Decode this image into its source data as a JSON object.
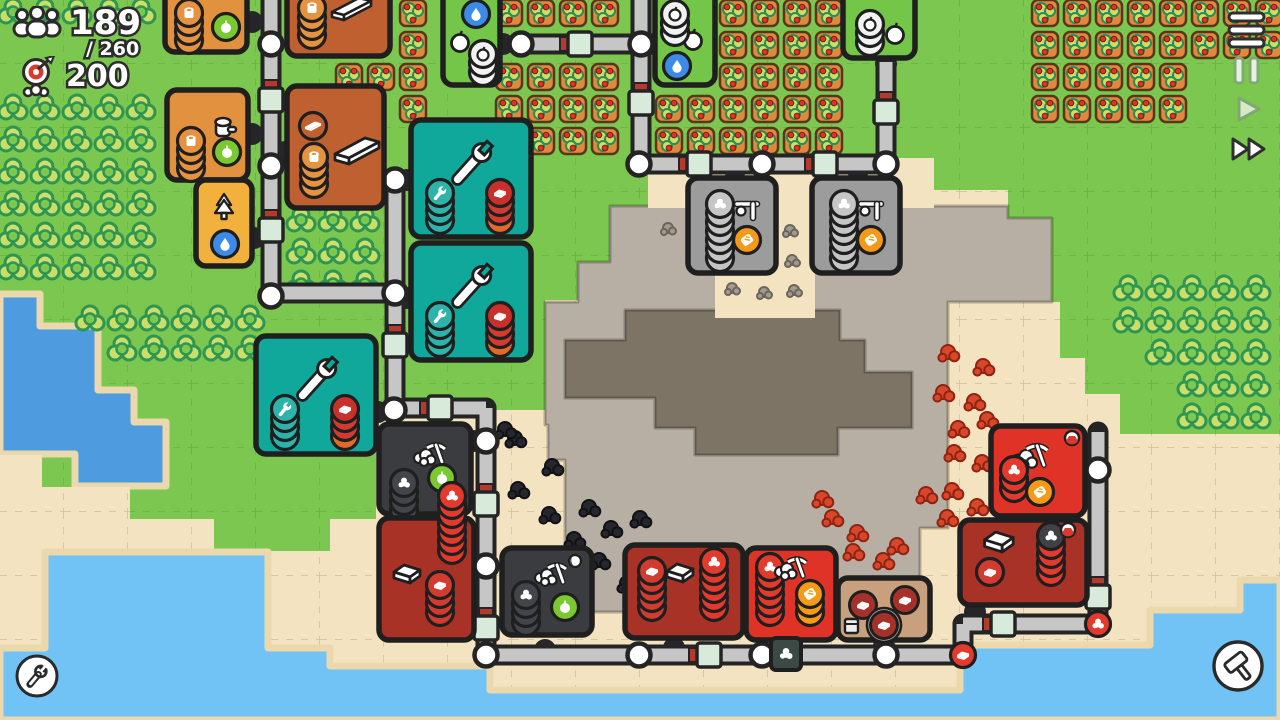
{
  "hud": {
    "population": {
      "current": "189",
      "max_label": "/ 260",
      "icon": "population-icon"
    },
    "goal": {
      "value": "200",
      "icon": "target-goal-icon"
    }
  },
  "controls": {
    "menu": "menu",
    "pause": "pause",
    "play": "play",
    "fast_forward": "fast-forward",
    "tools": "wrench-tools",
    "build": "build-hammer"
  },
  "map": {
    "colors": {
      "grass": "#7CC74F",
      "sand": "#F4E3C0",
      "quarry": "#B7AFA3",
      "quarryInner": "#7E7466",
      "lake": "#4E9BE0",
      "ocean": "#72C3F5",
      "shore": "#EBD8AD",
      "outline": "#1F1F1F",
      "beltGray": "#C6C6C6",
      "beltDark": "#242424",
      "mint": "#D8EBDA",
      "stripe": "#B23A2E",
      "teal": "#0FA89B",
      "tealCoin": "#2DB3A9",
      "lightOrange": "#E2913F",
      "darkOrange": "#BF6030",
      "amber": "#F2B13D",
      "farmGreen": "#74C649",
      "gray": "#9C9C9C",
      "grayCoin": "#C6C6C6",
      "dark": "#3A3C40",
      "coalCoin": "#43454A",
      "darkRed": "#A93226",
      "red": "#DF3328",
      "redCoin": "#E23A2C",
      "brown": "#C8A07E",
      "appleGreen": "#7CC832",
      "waterCoin": "#3D8BE8",
      "orangeCoin": "#F59A18",
      "treeFill": "#C9DF69",
      "treeStroke": "#2E9552",
      "treeInner": "#7CC94F",
      "berryTile": "#E2883E",
      "berryBorder": "#54381B",
      "berry": "#E03028",
      "coal": "#26272C",
      "iron": "#D8472A",
      "stone": "#A29B8F"
    },
    "terrain": {
      "sand": "M0,455 H42 V487 H130 V519 H214 V551 H330 V519 H376 V410 H545 V300 H578 V262 H610 V206 H648 V158 H934 V190 H1008 V218 H1052 V302 H1060 V358 H1085 V394 H1120 V434 H1280 V720 H0 Z",
      "quarry": "M545,302 H578 V262 H610 V206 H1008 V218 H1052 V302 H948 V528 H920 V612 H590 V560 H565 V460 H548 V425 H545 Z",
      "quarryInner": "M565,340 H625 V310 H840 V340 H865 V372 H912 V428 H838 V455 H695 V428 H655 V398 H565 Z",
      "lake": "M0,294 L40,294 L40,326 L98,326 L98,390 L134,390 L134,422 L166,422 L166,486 L75,486 L75,454 L0,454 Z",
      "ocean": "M0,648 H45 V552 H268 V648 H330 V666 H490 V690 H960 V645 H1150 V610 H1240 V580 H1280 V720 H0 Z",
      "sandPatches": [
        [
          648,
          160,
          286,
          48
        ],
        [
          772,
          205,
          42,
          113
        ],
        [
          715,
          272,
          100,
          46
        ]
      ]
    },
    "tiles": {
      "berries": [
        [
          13,
          [
            413,
            509,
            541,
            573,
            605,
            733,
            765,
            797,
            829,
            1045,
            1077,
            1109,
            1141,
            1173,
            1205,
            1237,
            1269
          ]
        ],
        [
          45,
          [
            413,
            733,
            765,
            797,
            829,
            1045,
            1077,
            1109,
            1141,
            1173,
            1205,
            1237,
            1269
          ]
        ],
        [
          77,
          [
            349,
            381,
            413,
            509,
            541,
            573,
            605,
            733,
            765,
            797,
            829,
            1045,
            1077,
            1109,
            1141,
            1173
          ]
        ],
        [
          109,
          [
            413,
            509,
            541,
            573,
            605,
            669,
            701,
            733,
            765,
            797,
            829,
            1045,
            1077,
            1109,
            1141,
            1173
          ]
        ],
        [
          141,
          [
            541,
            573,
            605,
            669,
            701,
            733,
            765,
            797,
            829
          ]
        ]
      ],
      "trees": [
        [
          13,
          [
            13,
            45,
            77,
            109,
            141
          ]
        ],
        [
          109,
          [
            13,
            45,
            77,
            109,
            141
          ]
        ],
        [
          141,
          [
            13,
            45,
            77,
            109,
            141
          ]
        ],
        [
          173,
          [
            13,
            45,
            77,
            109,
            141
          ]
        ],
        [
          205,
          [
            13,
            45,
            77,
            109,
            141
          ]
        ],
        [
          237,
          [
            13,
            45,
            77,
            109,
            141
          ]
        ],
        [
          269,
          [
            13,
            45,
            77,
            109,
            141
          ]
        ],
        [
          221,
          [
            301,
            333,
            365
          ]
        ],
        [
          253,
          [
            301,
            333,
            365
          ]
        ],
        [
          285,
          [
            301,
            333,
            365
          ]
        ],
        [
          320,
          [
            90,
            122,
            154,
            186,
            218,
            250
          ]
        ],
        [
          350,
          [
            122,
            154,
            186,
            218,
            250
          ]
        ],
        [
          290,
          [
            1128,
            1160,
            1192,
            1224,
            1256
          ]
        ],
        [
          322,
          [
            1128,
            1160,
            1192,
            1224,
            1256
          ]
        ],
        [
          354,
          [
            1160,
            1192,
            1224,
            1256
          ]
        ],
        [
          386,
          [
            1192,
            1224,
            1256
          ]
        ],
        [
          418,
          [
            1192,
            1224,
            1256
          ]
        ]
      ],
      "stone": [
        [
          668,
          228
        ],
        [
          790,
          230
        ],
        [
          792,
          260
        ],
        [
          732,
          288
        ],
        [
          764,
          292
        ],
        [
          794,
          290
        ]
      ],
      "coal": [
        [
          515,
          438
        ],
        [
          552,
          466
        ],
        [
          518,
          489
        ],
        [
          549,
          514
        ],
        [
          589,
          507
        ],
        [
          574,
          539
        ],
        [
          611,
          528
        ],
        [
          640,
          518
        ],
        [
          599,
          560
        ],
        [
          556,
          584
        ],
        [
          627,
          583
        ],
        [
          650,
          553
        ],
        [
          505,
          429
        ]
      ],
      "iron": [
        [
          948,
          352
        ],
        [
          983,
          366
        ],
        [
          943,
          392
        ],
        [
          974,
          401
        ],
        [
          958,
          428
        ],
        [
          987,
          419
        ],
        [
          954,
          452
        ],
        [
          982,
          462
        ],
        [
          952,
          490
        ],
        [
          977,
          506
        ],
        [
          926,
          494
        ],
        [
          947,
          517
        ],
        [
          832,
          517
        ],
        [
          857,
          532
        ],
        [
          883,
          560
        ],
        [
          853,
          551
        ],
        [
          897,
          545
        ],
        [
          822,
          498
        ]
      ]
    },
    "belts": {
      "segments": [
        [
          271,
          -8,
          271,
          296
        ],
        [
          641,
          -8,
          641,
          164
        ],
        [
          521,
          44,
          641,
          44
        ],
        [
          639,
          164,
          886,
          164
        ],
        [
          886,
          62,
          886,
          164
        ],
        [
          395,
          178,
          395,
          410
        ],
        [
          271,
          293,
          395,
          293
        ],
        [
          394,
          408,
          486,
          408
        ],
        [
          486,
          408,
          486,
          655
        ],
        [
          486,
          655,
          963,
          655
        ],
        [
          963,
          624,
          963,
          655
        ],
        [
          963,
          624,
          1098,
          624
        ],
        [
          1098,
          432,
          1098,
          624
        ]
      ],
      "nodes": [
        [
          271,
          44
        ],
        [
          271,
          166
        ],
        [
          271,
          296
        ],
        [
          521,
          44
        ],
        [
          641,
          44
        ],
        [
          639,
          164
        ],
        [
          762,
          164
        ],
        [
          886,
          164
        ],
        [
          395,
          180
        ],
        [
          395,
          293
        ],
        [
          394,
          410
        ],
        [
          486,
          441
        ],
        [
          486,
          566
        ],
        [
          486,
          655
        ],
        [
          639,
          655
        ],
        [
          762,
          655
        ],
        [
          886,
          655
        ],
        [
          1098,
          470
        ]
      ],
      "connectors": [
        [
          271,
          100,
          "v"
        ],
        [
          271,
          230,
          "v"
        ],
        [
          580,
          44,
          "h"
        ],
        [
          641,
          103,
          "v"
        ],
        [
          699,
          164,
          "h"
        ],
        [
          825,
          164,
          "h"
        ],
        [
          886,
          112,
          "v"
        ],
        [
          395,
          345,
          "v"
        ],
        [
          440,
          408,
          "h"
        ],
        [
          486,
          504,
          "v"
        ],
        [
          486,
          628,
          "v"
        ],
        [
          709,
          655,
          "h"
        ],
        [
          1003,
          624,
          "h"
        ],
        [
          1098,
          597,
          "v"
        ]
      ],
      "stripes": [
        [
          271,
          85,
          "v"
        ],
        [
          271,
          215,
          "v"
        ],
        [
          641,
          88,
          "v"
        ],
        [
          886,
          97,
          "v"
        ],
        [
          395,
          330,
          "v"
        ],
        [
          486,
          489,
          "v"
        ],
        [
          486,
          613,
          "v"
        ],
        [
          1098,
          582,
          "v"
        ],
        [
          565,
          44,
          "h"
        ],
        [
          684,
          164,
          "h"
        ],
        [
          810,
          164,
          "h"
        ],
        [
          425,
          408,
          "h"
        ],
        [
          694,
          655,
          "h"
        ],
        [
          988,
          624,
          "h"
        ]
      ],
      "ports": [
        [
          252,
          22
        ],
        [
          252,
          134
        ],
        [
          285,
          152
        ],
        [
          254,
          238
        ],
        [
          503,
          44
        ],
        [
          652,
          44
        ],
        [
          886,
          64
        ],
        [
          735,
          170
        ],
        [
          858,
          170
        ],
        [
          407,
          180
        ],
        [
          407,
          298
        ],
        [
          378,
          412
        ],
        [
          474,
          441
        ],
        [
          477,
          566
        ],
        [
          545,
          650
        ],
        [
          674,
          648
        ],
        [
          790,
          646
        ],
        [
          884,
          646
        ],
        [
          975,
          612
        ],
        [
          1087,
          470
        ]
      ],
      "items": [
        [
          963,
          655,
          "ingot"
        ],
        [
          1098,
          624,
          "ore"
        ]
      ]
    },
    "buildings": [
      {
        "id": "wood-camp-1",
        "type": "gatherer",
        "x": 165,
        "y": -30,
        "w": 82,
        "h": 82
      },
      {
        "id": "lumber-mill-1",
        "type": "lumber",
        "x": 287,
        "y": -32,
        "w": 103,
        "h": 88
      },
      {
        "id": "wood-camp-2",
        "type": "gatherer2",
        "x": 167,
        "y": 90,
        "w": 81,
        "h": 90
      },
      {
        "id": "lumber-mill-2",
        "type": "lumber2",
        "x": 287,
        "y": 86,
        "w": 97,
        "h": 122
      },
      {
        "id": "tree-planter",
        "type": "planter",
        "x": 196,
        "y": 180,
        "w": 56,
        "h": 86
      },
      {
        "id": "orchard-1",
        "type": "farm",
        "x": 443,
        "y": -14,
        "w": 57,
        "h": 99
      },
      {
        "id": "orchard-2",
        "type": "farm2",
        "x": 655,
        "y": -14,
        "w": 60,
        "h": 99
      },
      {
        "id": "orchard-3",
        "type": "farm3",
        "x": 843,
        "y": -16,
        "w": 72,
        "h": 74
      },
      {
        "id": "extractor-1",
        "type": "extractor",
        "x": 688,
        "y": 178,
        "w": 88,
        "h": 95
      },
      {
        "id": "extractor-2",
        "type": "extractor",
        "x": 812,
        "y": 178,
        "w": 88,
        "h": 95
      },
      {
        "id": "workshop-1",
        "type": "workshop",
        "x": 411,
        "y": 120,
        "w": 120,
        "h": 117
      },
      {
        "id": "workshop-2",
        "type": "workshop",
        "x": 411,
        "y": 243,
        "w": 120,
        "h": 117
      },
      {
        "id": "workshop-3",
        "type": "workshop",
        "x": 256,
        "y": 336,
        "w": 120,
        "h": 118
      },
      {
        "id": "coal-mine-1",
        "type": "coalmine",
        "x": 379,
        "y": 424,
        "w": 92,
        "h": 90
      },
      {
        "id": "furnace-1",
        "type": "furnace1",
        "x": 379,
        "y": 518,
        "w": 95,
        "h": 122
      },
      {
        "id": "coal-mine-2",
        "type": "coalmine2",
        "x": 502,
        "y": 548,
        "w": 90,
        "h": 87
      },
      {
        "id": "furnace-2",
        "type": "furnace2",
        "x": 625,
        "y": 545,
        "w": 118,
        "h": 93
      },
      {
        "id": "iron-mine-1",
        "type": "ironmine1",
        "x": 746,
        "y": 548,
        "w": 90,
        "h": 92
      },
      {
        "id": "depot",
        "type": "storage",
        "x": 838,
        "y": 578,
        "w": 92,
        "h": 62
      },
      {
        "id": "iron-mine-2",
        "type": "ironmine2",
        "x": 991,
        "y": 426,
        "w": 94,
        "h": 90
      },
      {
        "id": "furnace-3",
        "type": "furnace3",
        "x": 960,
        "y": 520,
        "w": 127,
        "h": 85
      },
      {
        "id": "belt-filter",
        "type": "filter",
        "x": 771,
        "y": 638,
        "w": 30,
        "h": 32
      }
    ]
  }
}
